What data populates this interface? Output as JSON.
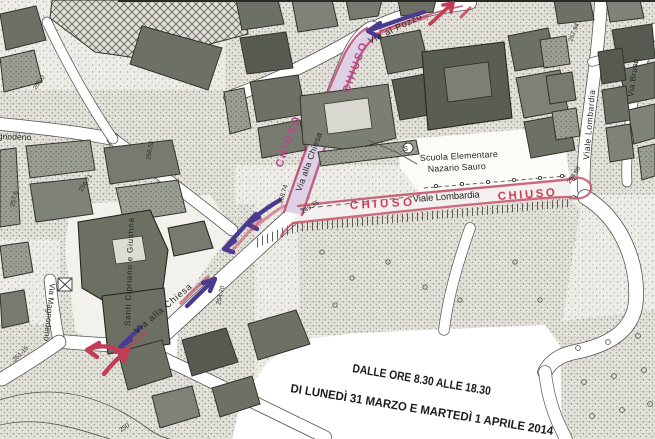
{
  "map": {
    "streets": {
      "via_alla_chiesa": "Via alla Chiesa",
      "via_al_pozzo": "Via al Pozzo",
      "viale_lombardia": "Viale Lombardia",
      "via_bruso": "Via Bruso",
      "via_magnodeno": "Via Magnodeno"
    },
    "labels": {
      "closed": "CHIUSO",
      "church": "Santi Cipriano e Giustina",
      "school_line1": "Scuola Elementare",
      "school_line2": "Nazario Sauro",
      "symbol_s": "S"
    },
    "elevations": [
      "256.0",
      "257.6",
      "256.71",
      "256.52",
      "258.74",
      "249.35",
      "257.94",
      "254.88",
      "254.70",
      "251.15",
      "250"
    ],
    "notice": {
      "line1": "DALLE ORE 8.30 ALLE 18.30",
      "line2": "DI LUNEDÌ 31 MARZO E MARTEDÌ 1 APRILE 2014"
    },
    "colors": {
      "closure_red": "#c4556a",
      "closure_red2": "#b84d72",
      "chiuso_red": "#cb4058",
      "chiuso_magenta": "#b8488a",
      "arrow_purple": "#4b3b8f",
      "arrow_red": "#c23c55"
    }
  }
}
